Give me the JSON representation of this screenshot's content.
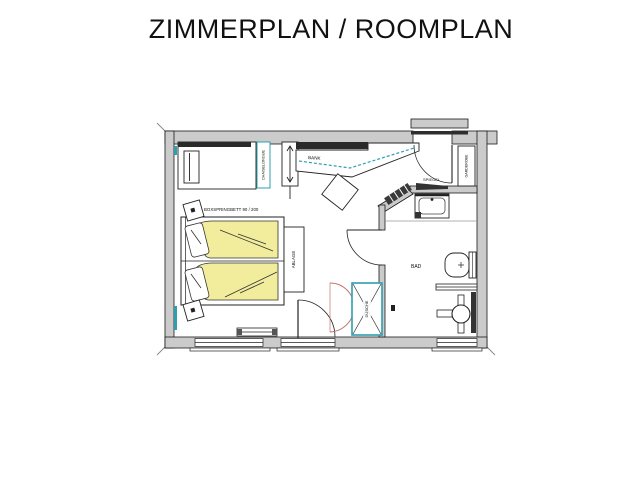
{
  "page": {
    "title": "ZIMMERPLAN / ROOMPLAN"
  },
  "plan": {
    "labels": {
      "bench": "BANK",
      "daybed": "CHAISELONGUE",
      "bed": "BOXSPRINGBETT 90 / 200",
      "shelf": "ABLAGE",
      "bathroom": "BAD",
      "mirror": "SPIEGEL",
      "wardrobe": "GARDEROBE",
      "shower": "DUSCHE"
    },
    "colors": {
      "wall_fill": "#cbcbcb",
      "accent_teal": "#2f9fae",
      "bed_yellow": "#f1ed9c",
      "door_red": "#c4736b"
    }
  }
}
